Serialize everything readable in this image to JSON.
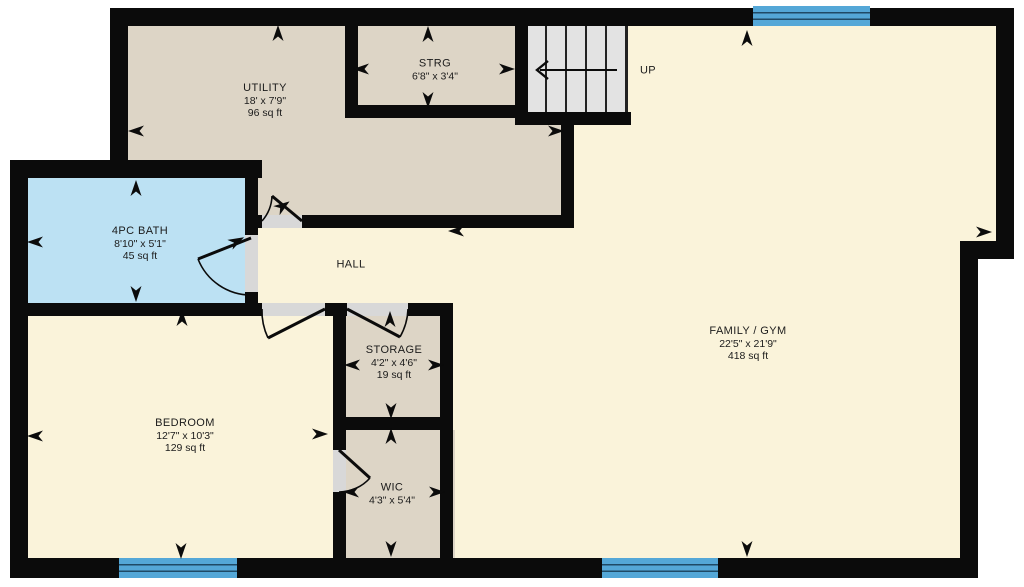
{
  "title": "Basement floor plan",
  "palette": {
    "wall": "#0b0b0b",
    "cream": "#faf3da",
    "beige": "#ddd5c6",
    "bath_blue": "#bce1f3",
    "stairs_grey": "#e3e3e3",
    "window_blue": "#54a7d7",
    "window_line": "#1f4a66",
    "door_gap": "#d8d8d8",
    "label": "#1b1b1b",
    "thin_edge": "#222222"
  },
  "regions": [
    {
      "id": "utility-floor",
      "color": "beige",
      "rect": [
        110,
        10,
        464,
        218
      ]
    },
    {
      "id": "family-floor-a",
      "color": "cream",
      "rect": [
        627,
        26,
        387,
        226
      ]
    },
    {
      "id": "family-floor-b",
      "color": "cream",
      "rect": [
        574,
        112,
        404,
        446
      ]
    },
    {
      "id": "family-floor-c",
      "color": "cream",
      "rect": [
        453,
        228,
        130,
        330
      ]
    },
    {
      "id": "hall-floor",
      "color": "cream",
      "rect": [
        252,
        228,
        322,
        88
      ]
    },
    {
      "id": "bath-floor",
      "color": "bath_blue",
      "rect": [
        28,
        178,
        230,
        125
      ]
    },
    {
      "id": "bedroom-floor",
      "color": "cream",
      "rect": [
        28,
        303,
        310,
        255
      ]
    },
    {
      "id": "storage-floor",
      "color": "beige",
      "rect": [
        340,
        303,
        113,
        127
      ]
    },
    {
      "id": "wic-floor",
      "color": "beige",
      "rect": [
        340,
        430,
        115,
        128
      ]
    },
    {
      "id": "stairs-floor",
      "color": "stairs_grey",
      "rect": [
        521,
        26,
        106,
        86
      ]
    }
  ],
  "walls": [
    [
      110,
      8,
      904,
      18
    ],
    [
      996,
      8,
      18,
      251
    ],
    [
      960,
      241,
      54,
      18
    ],
    [
      960,
      241,
      18,
      337
    ],
    [
      10,
      558,
      968,
      20
    ],
    [
      10,
      160,
      18,
      418
    ],
    [
      10,
      160,
      252,
      18
    ],
    [
      110,
      8,
      18,
      170
    ],
    [
      345,
      26,
      13,
      92
    ],
    [
      345,
      105,
      183,
      13
    ],
    [
      515,
      26,
      13,
      99
    ],
    [
      515,
      112,
      116,
      13
    ],
    [
      561,
      112,
      13,
      116
    ],
    [
      250,
      215,
      12,
      13
    ],
    [
      302,
      215,
      272,
      13
    ],
    [
      245,
      178,
      13,
      57
    ],
    [
      245,
      292,
      13,
      11
    ],
    [
      10,
      303,
      252,
      13
    ],
    [
      325,
      303,
      22,
      13
    ],
    [
      408,
      303,
      45,
      13
    ],
    [
      333,
      303,
      13,
      147
    ],
    [
      333,
      492,
      13,
      66
    ],
    [
      440,
      303,
      13,
      255
    ],
    [
      333,
      417,
      120,
      13
    ]
  ],
  "thin_walls": [
    [
      625,
      26,
      3,
      86
    ]
  ],
  "door_gaps": [
    {
      "id": "utility-door-gap",
      "rect": [
        262,
        215,
        40,
        13
      ]
    },
    {
      "id": "bath-door-gap",
      "rect": [
        245,
        235,
        13,
        57
      ]
    },
    {
      "id": "bedroom-door-gap",
      "rect": [
        262,
        303,
        63,
        13
      ]
    },
    {
      "id": "storage-door-gap",
      "rect": [
        347,
        303,
        61,
        13
      ]
    },
    {
      "id": "wic-door-gap",
      "rect": [
        333,
        450,
        13,
        42
      ]
    }
  ],
  "windows": [
    {
      "id": "window-top-family",
      "rect": [
        753,
        6,
        117,
        20
      ]
    },
    {
      "id": "window-bottom-bedroom",
      "rect": [
        119,
        558,
        118,
        20
      ]
    },
    {
      "id": "window-bottom-family",
      "rect": [
        602,
        558,
        116,
        20
      ]
    }
  ],
  "doors": [
    {
      "id": "utility-door",
      "leaf": "M302 221 L272 196",
      "arc": "M262 221 A40 40 0 0 0 272 196"
    },
    {
      "id": "bath-door",
      "leaf": "M251 238 L198 259",
      "arc": "M251 295 A57 57 0 0 1 198 259"
    },
    {
      "id": "bedroom-door",
      "leaf": "M325 309 L268 338",
      "arc": "M262 309 A63 63 0 0 0 268 338"
    },
    {
      "id": "storage-door",
      "leaf": "M347 309 L400 337",
      "arc": "M408 309 A61 61 0 0 1 400 337"
    },
    {
      "id": "wic-door",
      "leaf": "M339 450 L370 478",
      "arc": "M339 492 A42 42 0 0 0 370 478"
    }
  ],
  "stairs": {
    "rect": [
      521,
      26,
      106,
      86
    ],
    "treads_x": [
      545,
      565,
      585,
      605
    ],
    "tread_top": 26,
    "tread_bottom": 112,
    "arrow_line": [
      617,
      70,
      540,
      70
    ],
    "arrow_head": "548,61 537,70 548,79",
    "label": "UP",
    "label_cx": 648,
    "label_cy": 71
  },
  "rooms": [
    {
      "id": "utility",
      "name": "UTILITY",
      "dims": "18' x 7'9\"",
      "area": "96 sq ft",
      "cx": 265,
      "cy": 101
    },
    {
      "id": "strg",
      "name": "STRG",
      "dims": "6'8\" x 3'4\"",
      "area": "",
      "cx": 435,
      "cy": 70
    },
    {
      "id": "bath",
      "name": "4PC BATH",
      "dims": "8'10\" x 5'1\"",
      "area": "45 sq ft",
      "cx": 140,
      "cy": 244
    },
    {
      "id": "hall",
      "name": "HALL",
      "dims": "",
      "area": "",
      "cx": 351,
      "cy": 265
    },
    {
      "id": "family",
      "name": "FAMILY / GYM",
      "dims": "22'5\" x 21'9\"",
      "area": "418 sq ft",
      "cx": 748,
      "cy": 344
    },
    {
      "id": "bedroom",
      "name": "BEDROOM",
      "dims": "12'7\" x 10'3\"",
      "area": "129 sq ft",
      "cx": 185,
      "cy": 436
    },
    {
      "id": "storage",
      "name": "STORAGE",
      "dims": "4'2\" x 4'6\"",
      "area": "19 sq ft",
      "cx": 394,
      "cy": 363
    },
    {
      "id": "wic",
      "name": "WIC",
      "dims": "4'3\" x 5'4\"",
      "area": "",
      "cx": 392,
      "cy": 494
    }
  ],
  "arrows": [
    {
      "x": 278,
      "y": 33,
      "rot": 0
    },
    {
      "x": 136,
      "y": 131,
      "rot": 270
    },
    {
      "x": 556,
      "y": 131,
      "rot": 90
    },
    {
      "x": 428,
      "y": 34,
      "rot": 0
    },
    {
      "x": 361,
      "y": 69,
      "rot": 270
    },
    {
      "x": 507,
      "y": 69,
      "rot": 90
    },
    {
      "x": 428,
      "y": 100,
      "rot": 180
    },
    {
      "x": 136,
      "y": 188,
      "rot": 0
    },
    {
      "x": 35,
      "y": 242,
      "rot": 270
    },
    {
      "x": 136,
      "y": 294,
      "rot": 180
    },
    {
      "x": 237,
      "y": 241,
      "rot": 62
    },
    {
      "x": 283,
      "y": 206,
      "rot": 55
    },
    {
      "x": 456,
      "y": 231,
      "rot": 270
    },
    {
      "x": 747,
      "y": 38,
      "rot": 0
    },
    {
      "x": 984,
      "y": 232,
      "rot": 90
    },
    {
      "x": 747,
      "y": 549,
      "rot": 180
    },
    {
      "x": 182,
      "y": 318,
      "rot": 0
    },
    {
      "x": 35,
      "y": 436,
      "rot": 270
    },
    {
      "x": 320,
      "y": 434,
      "rot": 90
    },
    {
      "x": 181,
      "y": 551,
      "rot": 180
    },
    {
      "x": 390,
      "y": 319,
      "rot": 0
    },
    {
      "x": 352,
      "y": 365,
      "rot": 270
    },
    {
      "x": 436,
      "y": 365,
      "rot": 90
    },
    {
      "x": 391,
      "y": 411,
      "rot": 180
    },
    {
      "x": 391,
      "y": 436,
      "rot": 0
    },
    {
      "x": 351,
      "y": 492,
      "rot": 270
    },
    {
      "x": 437,
      "y": 492,
      "rot": 90
    },
    {
      "x": 391,
      "y": 549,
      "rot": 180
    }
  ]
}
